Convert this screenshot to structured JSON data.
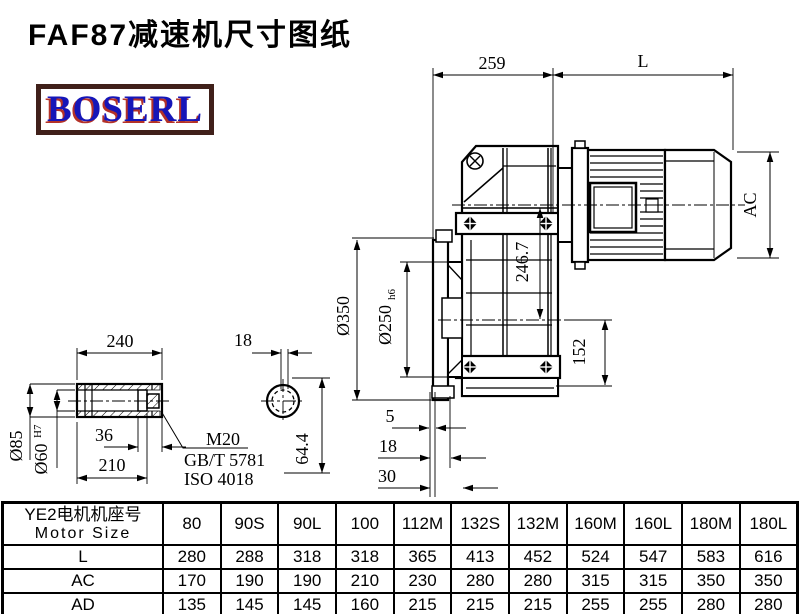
{
  "title": "FAF87减速机尺寸图纸",
  "logo": {
    "text": "BOSERL"
  },
  "colors": {
    "line": "#000000",
    "logo_text_blue": "#1616b8",
    "logo_shadow_red": "#b43228",
    "logo_border_brown": "#40201a"
  },
  "dims": {
    "len_259": "259",
    "len_L": "L",
    "dia_AC": "AC",
    "dia_350": "Ø350",
    "dia_250": "Ø250",
    "dia_250_tol": "h6",
    "len_246_7": "246.7",
    "len_152": "152",
    "len_5": "5",
    "len_18_flange": "18",
    "len_30": "30",
    "len_240": "240",
    "dia_85": "Ø85",
    "dia_60": "Ø60",
    "dia_60_tol": "H7",
    "len_36": "36",
    "len_210": "210",
    "len_18_key": "18",
    "len_64_4": "64.4"
  },
  "notes": {
    "thread": "M20",
    "standard_gb": "GB/T 5781",
    "standard_iso": "ISO 4018"
  },
  "table": {
    "header_cn": "YE2电机机座号",
    "header_en": "Motor Size",
    "columns": [
      "80",
      "90S",
      "90L",
      "100",
      "112M",
      "132S",
      "132M",
      "160M",
      "160L",
      "180M",
      "180L"
    ],
    "rows": [
      {
        "label": "L",
        "values": [
          "280",
          "288",
          "318",
          "318",
          "365",
          "413",
          "452",
          "524",
          "547",
          "583",
          "616"
        ]
      },
      {
        "label": "AC",
        "values": [
          "170",
          "190",
          "190",
          "210",
          "230",
          "280",
          "280",
          "315",
          "315",
          "350",
          "350"
        ]
      },
      {
        "label": "AD",
        "values": [
          "135",
          "145",
          "145",
          "160",
          "215",
          "215",
          "215",
          "255",
          "255",
          "280",
          "280"
        ]
      }
    ]
  }
}
